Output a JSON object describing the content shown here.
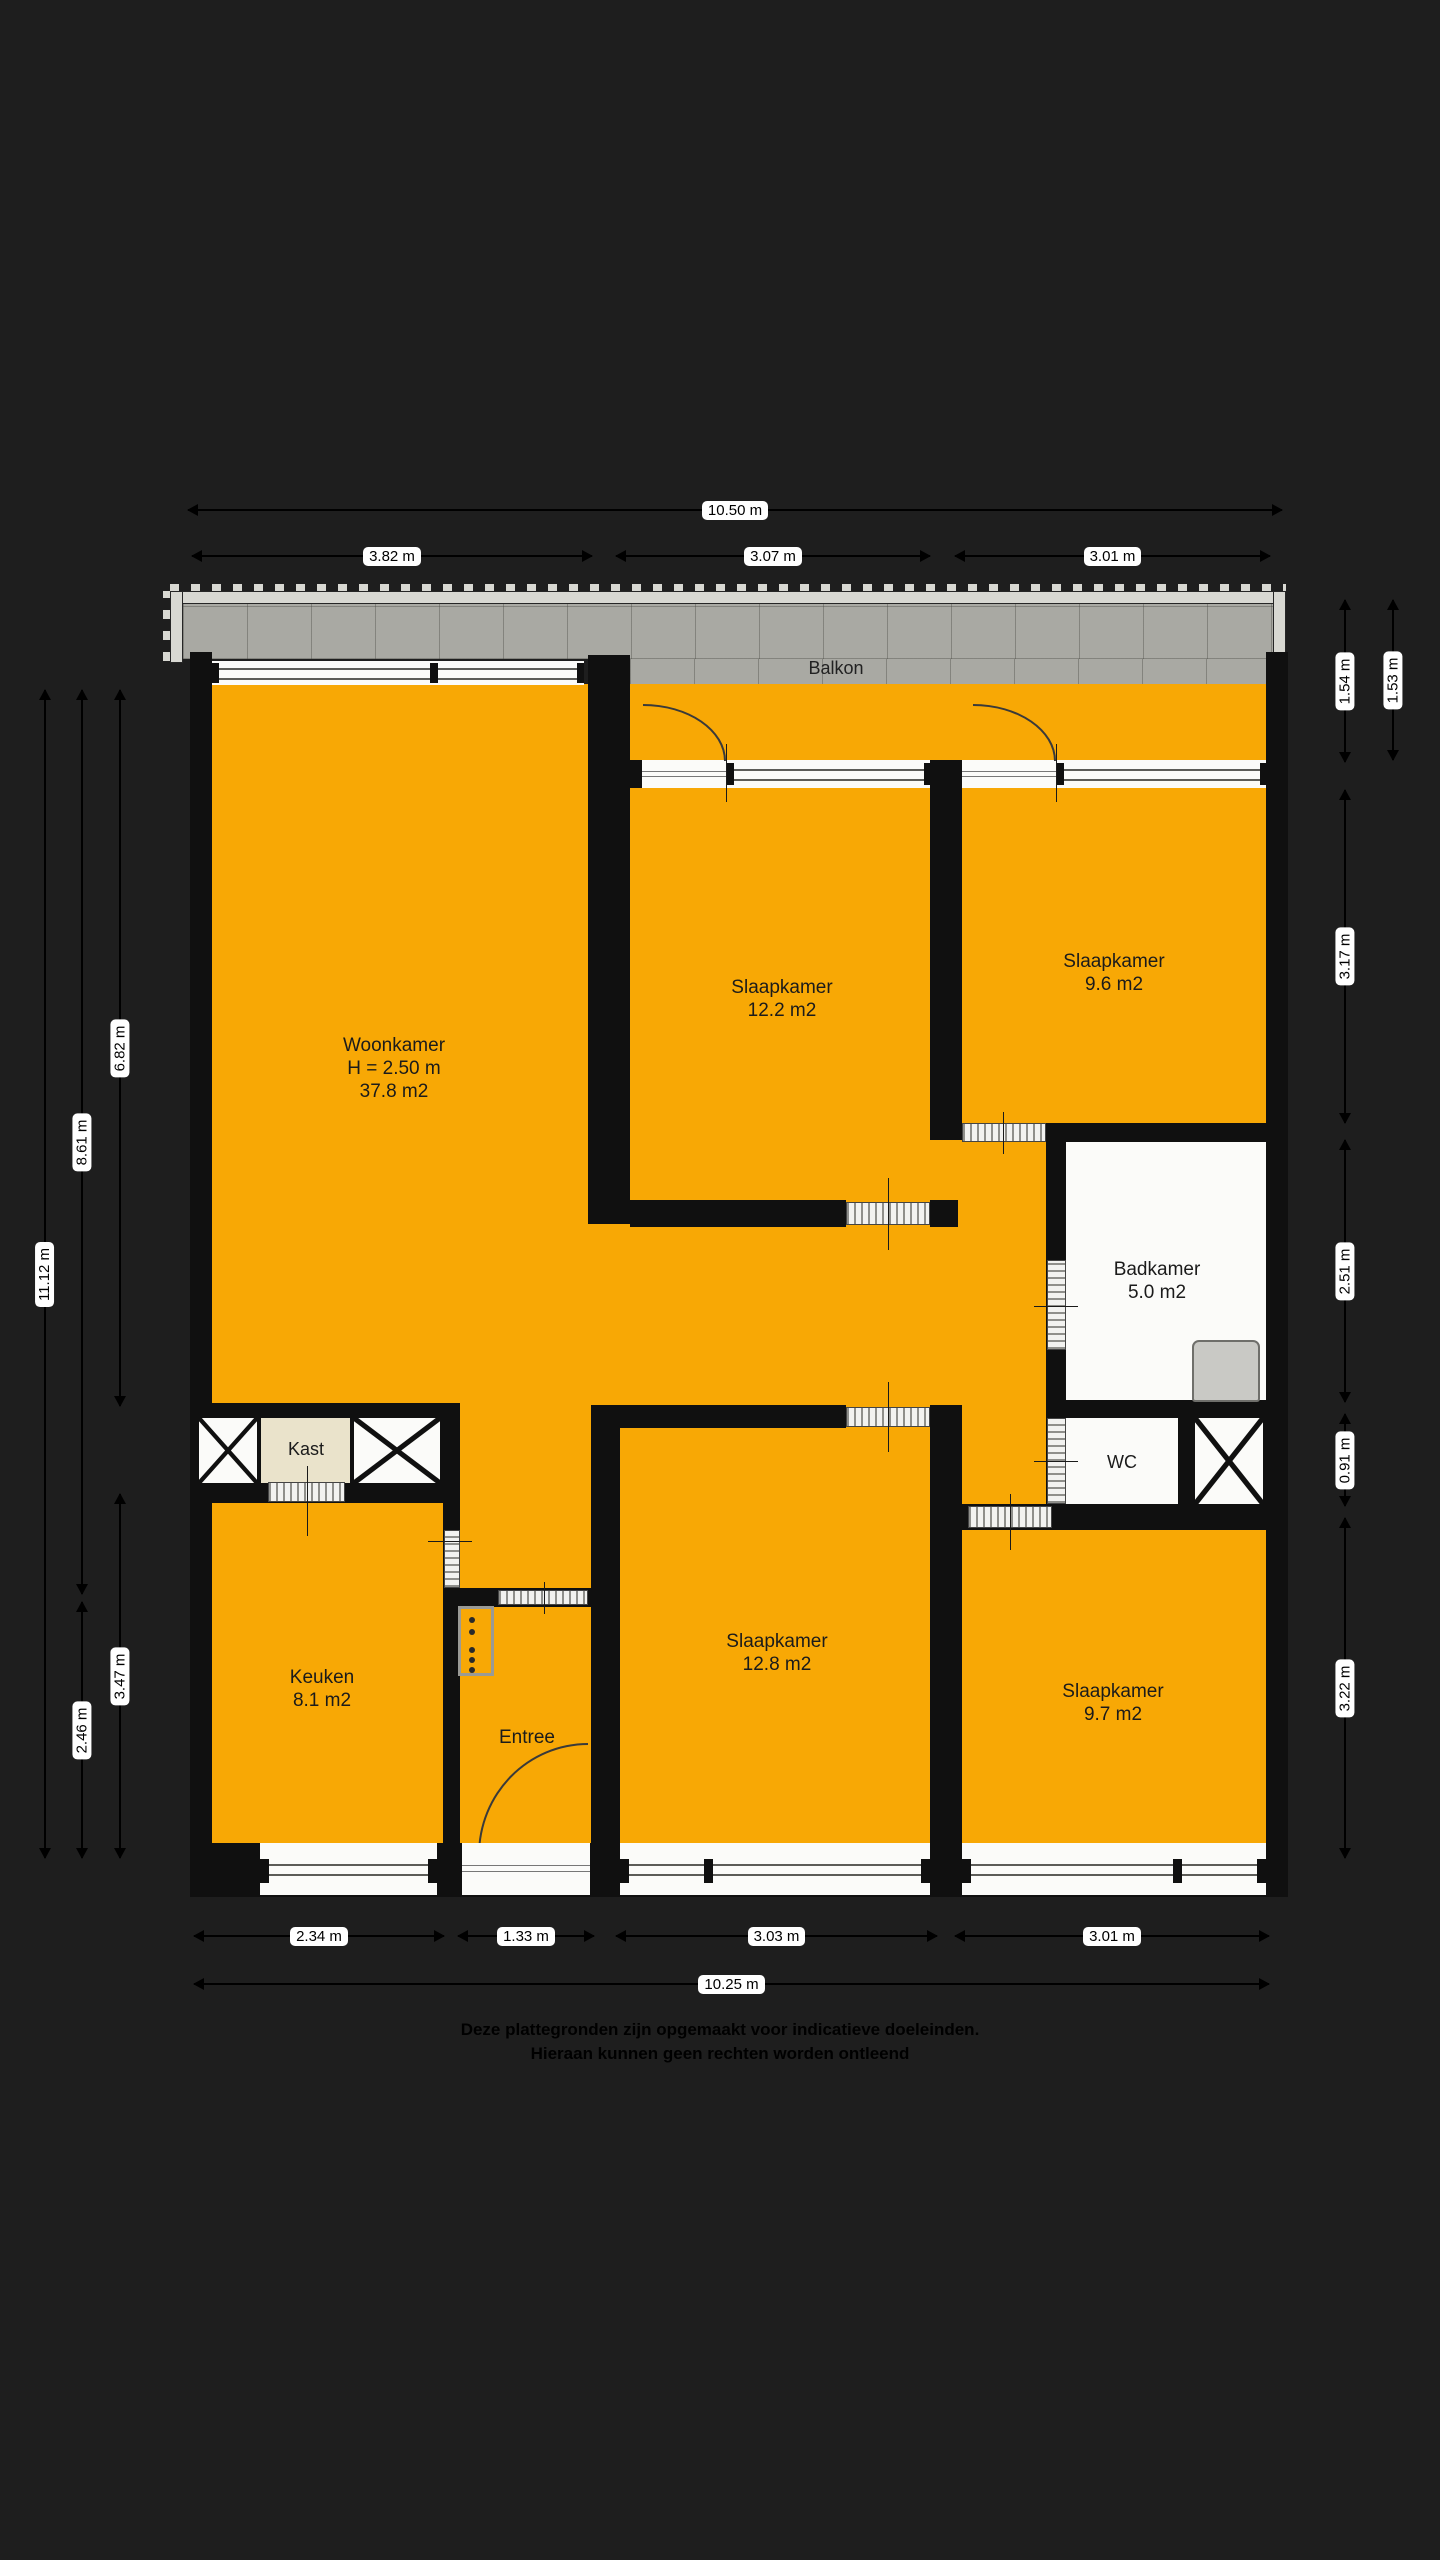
{
  "plan": {
    "balcony_label": "Balkon",
    "rooms": {
      "woonkamer": {
        "name": "Woonkamer",
        "height": "H = 2.50 m",
        "area": "37.8 m2"
      },
      "slaapkamer_boven_links": {
        "name": "Slaapkamer",
        "area": "12.2 m2"
      },
      "slaapkamer_boven_rechts": {
        "name": "Slaapkamer",
        "area": "9.6 m2"
      },
      "badkamer": {
        "name": "Badkamer",
        "area": "5.0 m2"
      },
      "wc": {
        "name": "WC"
      },
      "kast": {
        "name": "Kast"
      },
      "keuken": {
        "name": "Keuken",
        "area": "8.1 m2"
      },
      "entree": {
        "name": "Entree"
      },
      "slaapkamer_onder_midden": {
        "name": "Slaapkamer",
        "area": "12.8 m2"
      },
      "slaapkamer_onder_rechts": {
        "name": "Slaapkamer",
        "area": "9.7 m2"
      }
    },
    "dimensions": {
      "top": {
        "overall": "10.50 m",
        "segments": [
          "3.82 m",
          "3.07 m",
          "3.01 m"
        ]
      },
      "bottom": {
        "overall": "10.25 m",
        "segments": [
          "2.34 m",
          "1.33 m",
          "3.03 m",
          "3.01 m"
        ]
      },
      "left": [
        "11.12 m",
        "8.61 m",
        "6.82 m",
        "3.47 m",
        "2.46 m"
      ],
      "right": [
        "1.54 m",
        "1.53 m",
        "3.17 m",
        "2.51 m",
        "0.91 m",
        "3.22 m"
      ]
    },
    "colors": {
      "room_fill": "#F8A805",
      "balcony_tile": "#A9A9A3",
      "wall": "#101010",
      "closet_fill": "#EAE3CB",
      "background": "#1E1E1E"
    },
    "footer": {
      "line1": "Deze plattegronden zijn opgemaakt voor indicatieve doeleinden.",
      "line2": "Hieraan kunnen geen rechten worden ontleend"
    }
  }
}
